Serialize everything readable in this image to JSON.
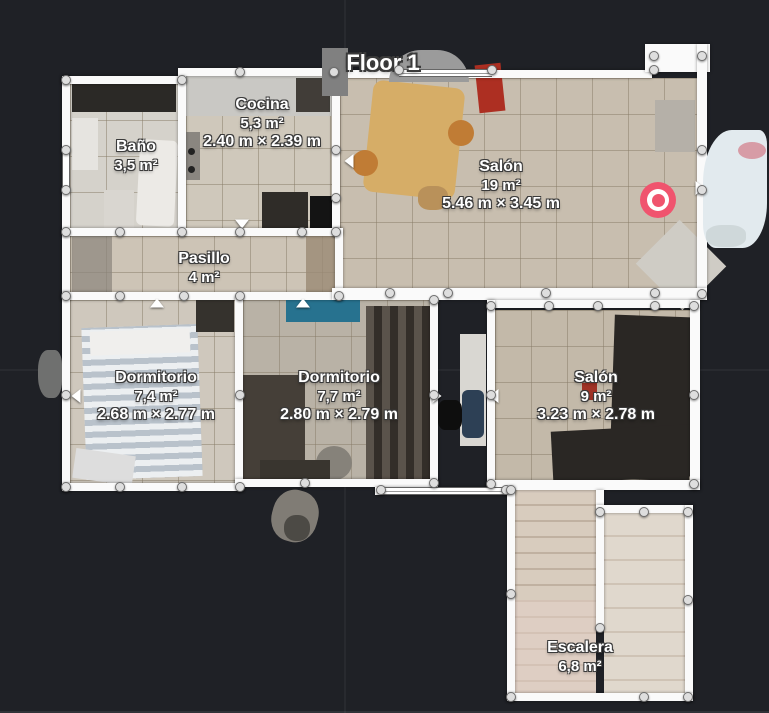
{
  "title": "Floor 1",
  "rooms": [
    {
      "name": "Baño",
      "area": "3,5 m²",
      "dims": ""
    },
    {
      "name": "Cocina",
      "area": "5,3 m²",
      "dims": "2.40 m × 2.39 m"
    },
    {
      "name": "Salón",
      "area": "19 m²",
      "dims": "5.46 m × 3.45 m"
    },
    {
      "name": "Pasillo",
      "area": "4 m²",
      "dims": ""
    },
    {
      "name": "Dormitorio",
      "area": "7,4 m²",
      "dims": "2.68 m × 2.77 m"
    },
    {
      "name": "Dormitorio",
      "area": "7,7 m²",
      "dims": "2.80 m × 2.79 m"
    },
    {
      "name": "Salón",
      "area": "9 m²",
      "dims": "3.23 m × 2.78 m"
    },
    {
      "name": "Escalera",
      "area": "6,8 m²",
      "dims": ""
    }
  ],
  "marker": {
    "icon": "camera-target-icon",
    "color": "#f0546e"
  },
  "colors": {
    "background": "#1f2126",
    "wall": "#fafafa",
    "handle": "#dedede"
  }
}
